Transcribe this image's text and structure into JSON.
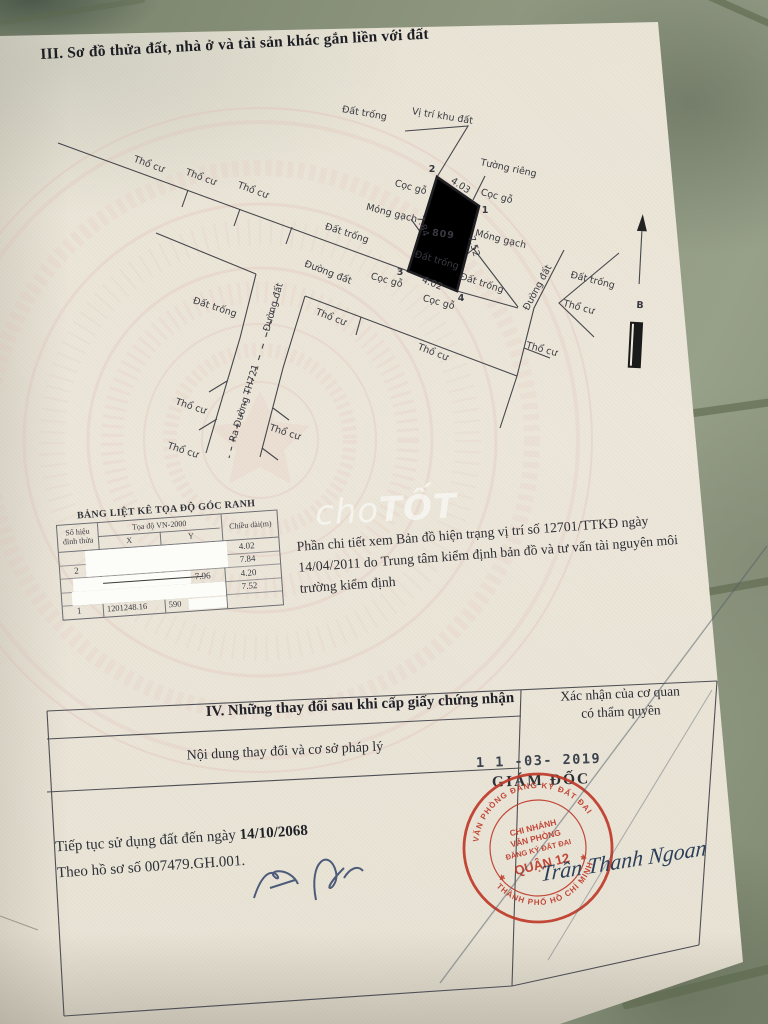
{
  "document": {
    "section3_title": "III. Sơ đồ thửa đất, nhà ở và tài sản khác gắn liền với đất",
    "watermark_cho": "cho",
    "watermark_tot": "TỐT"
  },
  "diagram": {
    "plot_number": "809",
    "corners": {
      "c1": "1",
      "c2": "2",
      "c3": "3",
      "c4": "4"
    },
    "edges": {
      "top": "4.03",
      "right": "7.52",
      "bottom": "4.02",
      "left": "7.84"
    },
    "north_label": "B",
    "labels": {
      "site_location": "Vị trí khu đất",
      "private_wall": "Tường riêng",
      "wood_stake": "Cọc gỗ",
      "brick_foundation": "Móng gạch",
      "vacant_land": "Đất trống",
      "residential_land": "Thổ cư",
      "dirt_road": "Đường đất",
      "to_road": "Ra Đường TH721"
    }
  },
  "coord_table": {
    "title": "BẢNG LIỆT KÊ TỌA ĐỘ GÓC RANH",
    "col_point_l1": "Số hiệu",
    "col_point_l2": "đỉnh thửa",
    "col_coord": "Tọa độ VN-2000",
    "col_x": "X",
    "col_y": "Y",
    "col_length": "Chiều dài(m)",
    "rows": [
      {
        "id": "",
        "x": "",
        "y": "",
        "len": "4.02"
      },
      {
        "id": "2",
        "x": "",
        "y": "",
        "len": "7.84"
      },
      {
        "id": "",
        "x": "",
        "y": "7.96",
        "len": "4.20"
      },
      {
        "id": "",
        "x": "",
        "y": "",
        "len": "7.52"
      },
      {
        "id": "1",
        "x": "1201248.16",
        "y": "590",
        "len": ""
      }
    ]
  },
  "note_text": "Phần chi tiết xem Bản đồ hiện trạng vị trí số 12701/TTKĐ ngày 14/04/2011 do Trung tâm kiểm định bản đồ và tư vấn tài nguyên môi trường kiểm định",
  "section4": {
    "title": "IV. Những thay đổi sau khi cấp giấy chứng nhận",
    "left_header": "Nội dung thay đổi và cơ sở pháp lý",
    "right_header_l1": "Xác nhận của cơ quan",
    "right_header_l2": "có thẩm quyền",
    "date_stamp": "1 1 -03- 2019",
    "director_title": "GIÁM ĐỐC",
    "signature_name": "Trần Thanh Ngoan",
    "usage_prefix": "Tiếp tục sử dụng đất đến ngày ",
    "usage_date": "14/10/2068",
    "dossier_line": "Theo hồ sơ số 007479.GH.001.",
    "stamp": {
      "ring_top": "VĂN PHÒNG ĐĂNG KÝ ĐẤT ĐAI",
      "ring_bottom": "THÀNH PHỐ HỒ CHÍ MINH",
      "center_l1": "CHI NHÁNH",
      "center_l2": "VĂN PHÒNG",
      "center_l3": "ĐĂNG KÝ ĐẤT ĐAI",
      "center_l4": "QUẬN 12",
      "color": "#b93a2b"
    }
  }
}
